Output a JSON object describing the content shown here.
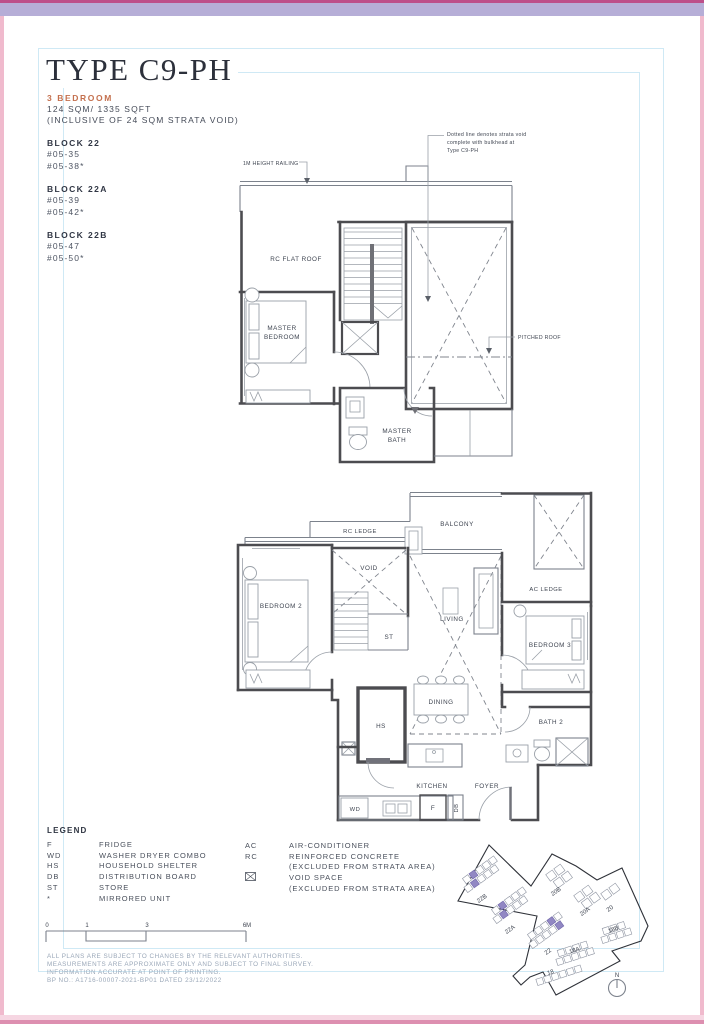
{
  "page": {
    "title": "TYPE C9-PH",
    "unit_type": "3 BEDROOM",
    "area": "124 SQM/ 1335 SQFT",
    "area_note": "(INCLUSIVE OF 24 SQM STRATA VOID)",
    "blocks": [
      {
        "name": "BLOCK 22",
        "units": [
          "#05-35",
          "#05-38*"
        ]
      },
      {
        "name": "BLOCK 22A",
        "units": [
          "#05-39",
          "#05-42*"
        ]
      },
      {
        "name": "BLOCK 22B",
        "units": [
          "#05-47",
          "#05-50*"
        ]
      }
    ]
  },
  "annotations": {
    "strata_note_line1": "Dotted line denotes strata void",
    "strata_note_line2": "complete with bulkhead at",
    "strata_note_line3": "Type C9-PH",
    "height_railing": "1M HEIGHT RAILING",
    "pitched_roof": "PITCHED ROOF"
  },
  "upper_plan": {
    "rc_flat_roof": "RC FLAT ROOF",
    "master_bedroom_line1": "MASTER",
    "master_bedroom_line2": "BEDROOM",
    "master_bath_line1": "MASTER",
    "master_bath_line2": "BATH"
  },
  "lower_plan": {
    "rc_ledge": "RC LEDGE",
    "balcony": "BALCONY",
    "void": "VOID",
    "bedroom2": "BEDROOM 2",
    "st": "ST",
    "living": "LIVING",
    "ac_ledge": "AC LEDGE",
    "bedroom3": "BEDROOM 3",
    "hs": "HS",
    "dining": "DINING",
    "bath2": "BATH 2",
    "kitchen": "KITCHEN",
    "foyer": "FOYER",
    "wd": "WD",
    "f": "F",
    "db": "DB"
  },
  "legend": {
    "title": "LEGEND",
    "col1": [
      {
        "abbr": "F",
        "label": "FRIDGE"
      },
      {
        "abbr": "WD",
        "label": "WASHER DRYER COMBO"
      },
      {
        "abbr": "HS",
        "label": "HOUSEHOLD SHELTER"
      },
      {
        "abbr": "DB",
        "label": "DISTRIBUTION BOARD"
      },
      {
        "abbr": "ST",
        "label": "STORE"
      },
      {
        "abbr": "*",
        "label": "MIRRORED UNIT"
      }
    ],
    "col2": [
      {
        "abbr": "AC",
        "label": "AIR-CONDITIONER",
        "note": ""
      },
      {
        "abbr": "RC",
        "label": "REINFORCED CONCRETE",
        "note": "(EXCLUDED FROM STRATA AREA)"
      },
      {
        "abbr": "",
        "label": "VOID SPACE",
        "note": "(EXCLUDED FROM STRATA AREA)"
      }
    ]
  },
  "scale_bar": {
    "ticks": [
      "0",
      "1",
      "3",
      "6M"
    ]
  },
  "disclaimer": {
    "line1": "ALL PLANS ARE SUBJECT TO CHANGES BY THE RELEVANT AUTHORITIES.",
    "line2": "MEASUREMENTS ARE APPROXIMATE ONLY AND SUBJECT TO FINAL SURVEY.",
    "line3": "INFORMATION ACCURATE AT POINT OF PRINTING.",
    "line4": "BP NO.: A1716-00007-2021-BP01 DATED 23/12/2022"
  },
  "site_plan": {
    "blocks": [
      "22B",
      "22A",
      "22",
      "20B",
      "20A",
      "20",
      "18B",
      "18A",
      "18"
    ],
    "north_label": "N"
  },
  "colors": {
    "accent_terracotta": "#c4704e",
    "title_ink": "#2c303b",
    "frame_cyan": "#cfe9f5",
    "band_lavender": "#b6aed7",
    "band_magenta": "#bd4f8a",
    "edge_pink": "#f0bacd",
    "highlight_purple": "#9187c3",
    "wall_gray": "#4c4c50"
  }
}
